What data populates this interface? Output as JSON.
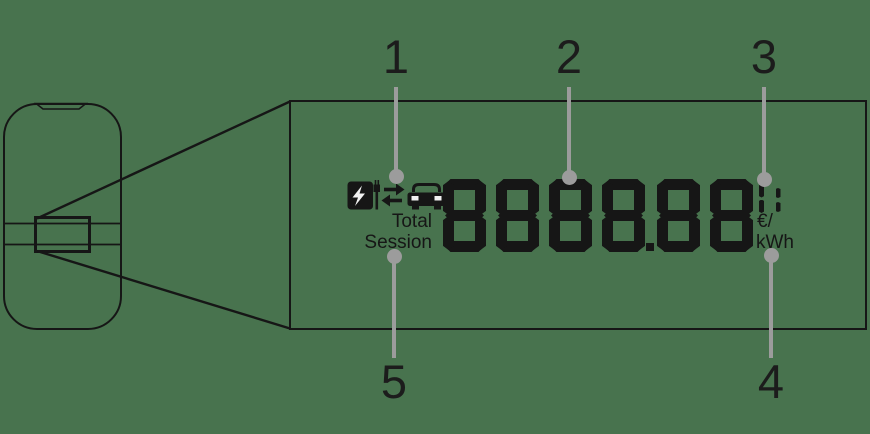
{
  "meta": {
    "colors": {
      "background": "#48734e",
      "ink": "#161616",
      "callout": "#9c9c9c"
    }
  },
  "display": {
    "segment_value": "8888.88",
    "indicator": "1:",
    "labels": {
      "total": "Total",
      "session": "Session",
      "currency_per": "€/",
      "energy_unit": "kWh"
    },
    "status_icons": [
      {
        "name": "charging-station-icon"
      },
      {
        "name": "bidirectional-arrows-icon"
      },
      {
        "name": "car-icon"
      }
    ]
  },
  "callouts": [
    {
      "label": "1",
      "x": 396,
      "side": "top",
      "dot_y": 176
    },
    {
      "label": "2",
      "x": 569,
      "side": "top",
      "dot_y": 177
    },
    {
      "label": "3",
      "x": 764,
      "side": "top",
      "dot_y": 179
    },
    {
      "label": "4",
      "x": 771,
      "side": "bottom",
      "dot_y": 255
    },
    {
      "label": "5",
      "x": 394,
      "side": "bottom",
      "dot_y": 256
    }
  ]
}
